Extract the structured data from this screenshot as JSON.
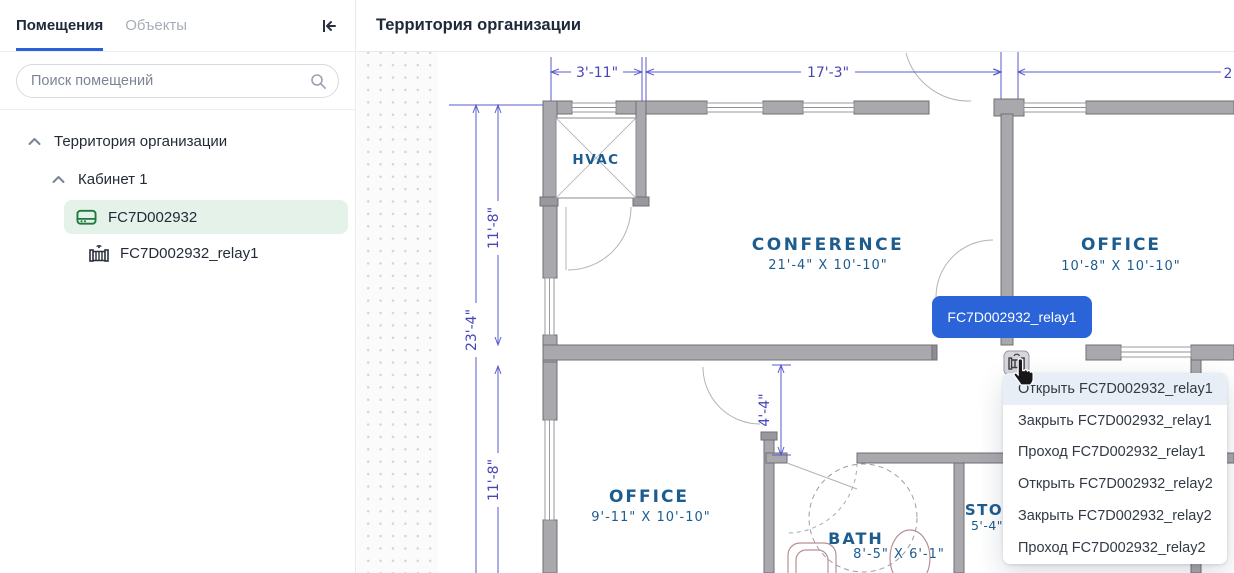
{
  "colors": {
    "accent_blue": "#2b62d6",
    "tooltip_blue": "#2b63d8",
    "selection_green_bg": "#e4f2e9",
    "device_icon_green": "#1e7a3c",
    "dimension_blue": "#5b5bce",
    "room_label_blue": "#1d5c8f",
    "menu_highlight": "#e8eef6"
  },
  "sidebar": {
    "tabs": [
      {
        "label": "Помещения"
      },
      {
        "label": "Объекты"
      }
    ],
    "search_placeholder": "Поиск помещений",
    "tree": {
      "territory": "Территория организации",
      "cabinet": "Кабинет 1",
      "device": "FC7D002932",
      "relay": "FC7D002932_relay1"
    }
  },
  "main": {
    "title": "Территория организации"
  },
  "plan": {
    "dims": {
      "top_left": "3'-11\"",
      "top_mid": "17'-3\"",
      "top_right_cut": "2",
      "left_total": "23'-4\"",
      "left_upper": "11'-8\"",
      "left_lower": "11'-8\"",
      "hall": "4'-4\""
    },
    "rooms": {
      "hvac": {
        "name": "HVAC"
      },
      "conference": {
        "name": "CONFERENCE",
        "size": "21'-4\" X 10'-10\""
      },
      "office_right": {
        "name": "OFFICE",
        "size": "10'-8\" X 10'-10\""
      },
      "office_left": {
        "name": "OFFICE",
        "size": "9'-11\" X 10'-10\""
      },
      "bath": {
        "name": "BATH",
        "size": "8'-5\" X 6'-1\""
      },
      "storage": {
        "name": "STO",
        "size": "5'-4\""
      }
    }
  },
  "tooltip": {
    "label": "FC7D002932_relay1"
  },
  "context_menu": {
    "items": [
      {
        "label": "Открыть FC7D002932_relay1"
      },
      {
        "label": "Закрыть FC7D002932_relay1"
      },
      {
        "label": "Проход FC7D002932_relay1"
      },
      {
        "label": "Открыть FC7D002932_relay2"
      },
      {
        "label": "Закрыть FC7D002932_relay2"
      },
      {
        "label": "Проход FC7D002932_relay2"
      }
    ]
  }
}
